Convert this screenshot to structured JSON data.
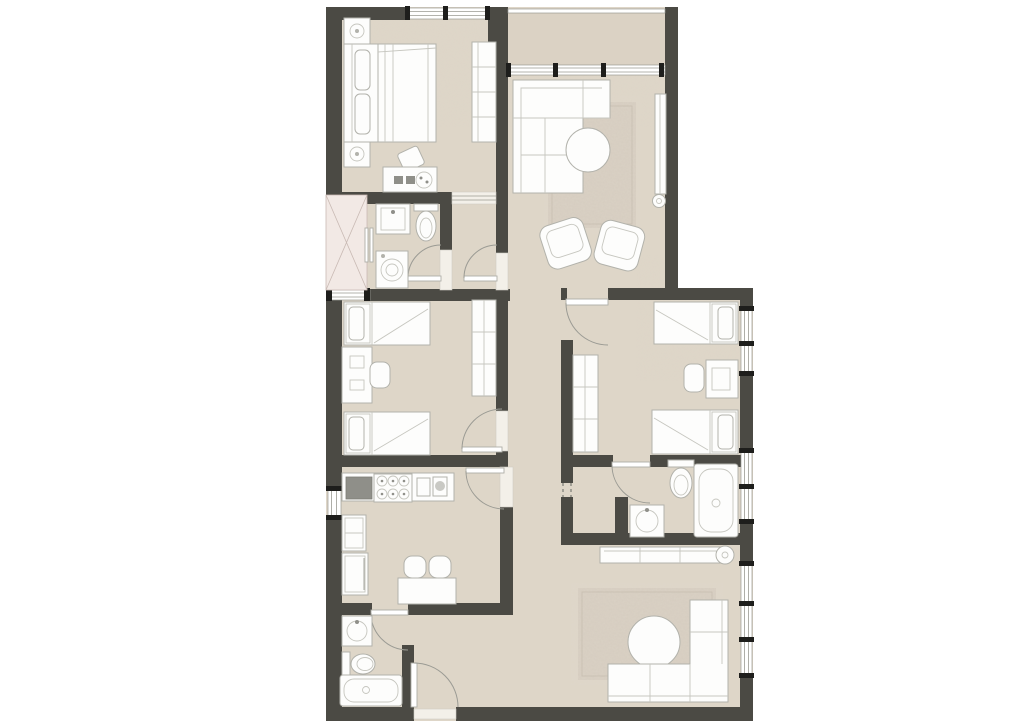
{
  "plan": {
    "title": "Apartment floor plan",
    "drawing_type": "top-down architectural floor plan",
    "text_labels": [],
    "rooms": [
      {
        "id": "master-bedroom",
        "position": "top-left",
        "furniture": [
          "double-bed",
          "pillows",
          "nightstand",
          "nightstand",
          "table-lamp",
          "table-lamp",
          "wardrobe",
          "dresser",
          "stool"
        ]
      },
      {
        "id": "terrace",
        "position": "top-right-above-glazing",
        "furniture": []
      },
      {
        "id": "living-room",
        "position": "top-right",
        "furniture": [
          "l-shaped-sofa",
          "rug",
          "round-coffee-table",
          "armchair",
          "armchair",
          "tv-unit",
          "floor-lamp"
        ]
      },
      {
        "id": "bathroom-1",
        "position": "mid-left",
        "furniture": [
          "shower-niche",
          "sliding-shower-door",
          "washbasin",
          "toilet",
          "washing-machine"
        ]
      },
      {
        "id": "vestibule",
        "position": "mid-center",
        "furniture": []
      },
      {
        "id": "kids-bedroom",
        "position": "left-middle",
        "furniture": [
          "single-bed",
          "single-bed",
          "desk",
          "desk-chair",
          "wardrobe"
        ]
      },
      {
        "id": "bedroom-3",
        "position": "right-middle",
        "furniture": [
          "single-bed",
          "single-bed",
          "desk",
          "desk-chair",
          "wardrobe"
        ]
      },
      {
        "id": "kitchen",
        "position": "lower-left",
        "furniture": [
          "countertop",
          "sink-basin",
          "gas-hob",
          "cutting-board",
          "small-appliance",
          "tall-unit",
          "fridge",
          "dining-table",
          "chair",
          "chair"
        ]
      },
      {
        "id": "hallway",
        "position": "center-spine",
        "furniture": []
      },
      {
        "id": "bathroom-2",
        "position": "lower-right",
        "furniture": [
          "toilet",
          "washbasin",
          "bathtub"
        ]
      },
      {
        "id": "bathroom-3",
        "position": "bottom-left",
        "furniture": [
          "washbasin",
          "toilet",
          "bathtub"
        ]
      },
      {
        "id": "entry-hall",
        "position": "bottom-center",
        "furniture": [
          "entry-door"
        ]
      },
      {
        "id": "lounge",
        "position": "bottom-right",
        "furniture": [
          "l-shaped-sofa",
          "rug",
          "round-coffee-table",
          "sideboard"
        ]
      }
    ],
    "door_count": 9,
    "window_count": 7
  },
  "colors": {
    "wall": "#4b4a44",
    "floor": "#ded6c8",
    "terrace": "#d8d0c1",
    "rug": "#d5ccbf",
    "shower": "#f2e9e5",
    "fixture_dark": "#8f8f89",
    "window_frame": "#1e1e1c",
    "background": "#ffffff"
  }
}
